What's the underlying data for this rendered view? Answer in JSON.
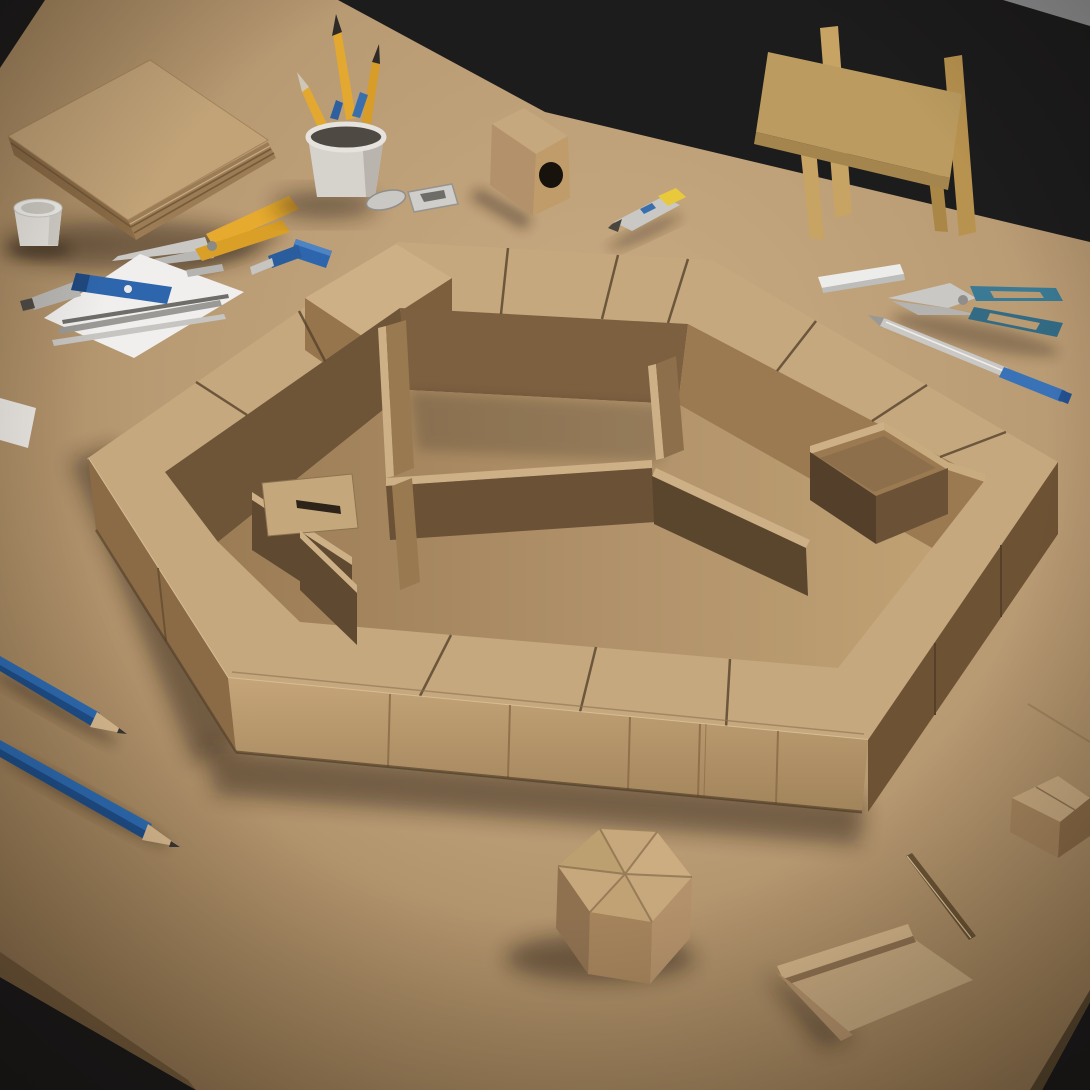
{
  "scene": {
    "type": "photograph",
    "setting": "Overhead three-quarter studio photo of a hexagonal cardboard architectural model with maze-like inner compartments, on a large tan craft table with cutting tools, against a dark backdrop.",
    "objects": [
      {
        "label": "dark studio backdrop",
        "color": "#1d1c1c"
      },
      {
        "label": "tan work table",
        "color": "#b89a73"
      },
      {
        "label": "cardboard chair",
        "color": "#c7a364"
      },
      {
        "label": "stack of cardboard sheets",
        "color": "#c2a378"
      },
      {
        "label": "small white cup",
        "color": "#e8e5e0"
      },
      {
        "label": "yellow-handled shears",
        "color": "#e5aa2e"
      },
      {
        "label": "pencil holder cup with pencils",
        "color": "#d6d3cd"
      },
      {
        "label": "metal clips",
        "color": "#c9c8c4"
      },
      {
        "label": "small cardboard box with round hole",
        "color": "#c9aa78"
      },
      {
        "label": "yellow utility knife",
        "color": "#e8c93c"
      },
      {
        "label": "white blade case",
        "color": "#ececea"
      },
      {
        "label": "blue-handled scissors",
        "color": "#3a7a94"
      },
      {
        "label": "metal scriber with blue grip",
        "color": "#c9c8c4"
      },
      {
        "label": "white paper with metal rulers",
        "color": "#f0efed"
      },
      {
        "label": "blue utility knife",
        "color": "#2e66ad"
      },
      {
        "label": "blue marking awl",
        "color": "#2e66ad"
      },
      {
        "label": "blue pencil upper",
        "color": "#2e6cb3"
      },
      {
        "label": "blue pencil lower",
        "color": "#2e6cb3"
      },
      {
        "label": "hexagonal cardboard model with inner compartments",
        "color": "#c6a87e"
      },
      {
        "label": "small hexagonal cardboard lid box",
        "color": "#c6a87c"
      },
      {
        "label": "cardboard tray lid",
        "color": "#c2a378"
      },
      {
        "label": "cardboard offcut piece",
        "color": "#c2a378"
      }
    ]
  },
  "palette": {
    "background_dark": "#1d1c1c",
    "background_gray": "#8e8e90",
    "table_base": "#b89a73",
    "table_edge": "#7a5f3e",
    "cardboard_top": "#c6a87e",
    "cardboard_light": "#cdb086",
    "cardboard_mid": "#b3916a",
    "cardboard_shade": "#8a6b46",
    "cardboard_dark": "#6e5538",
    "cardboard_deep": "#6e5234",
    "crevice": "#46331f",
    "wood": "#c7a364",
    "wood_dark": "#a5854e",
    "paper_white": "#f0efed",
    "cup_white": "#e8e5e0",
    "ceramic": "#d6d3cd",
    "pencil_yellow": "#e2a830",
    "tool_yellow": "#e5aa2e",
    "pencil_blue": "#2e6cb3",
    "tool_blue": "#2e66ad",
    "teal": "#3a7a94",
    "silver": "#c9c8c4",
    "silver_dark": "#9a9995",
    "hole_dark": "#17120c",
    "wood_tip": "#d9bb90",
    "lead_dark": "#3a3632"
  }
}
